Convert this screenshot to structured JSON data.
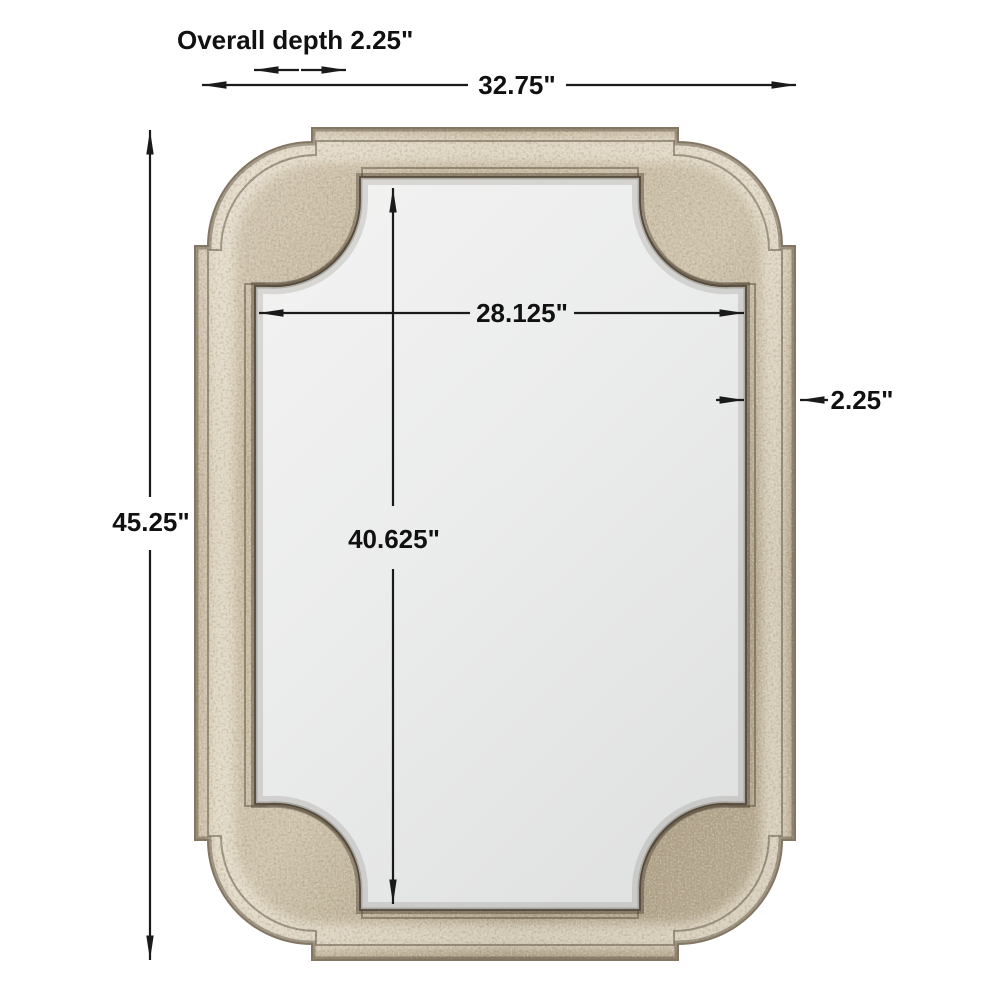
{
  "diagram": {
    "kind": "product-dimension-diagram",
    "subject": "antique silver framed wall mirror with scalloped stepped corners",
    "labels": {
      "overall_depth": "Overall depth 2.25\"",
      "overall_width": "32.75\"",
      "overall_height": "45.25\"",
      "mirror_width": "28.125\"",
      "mirror_height": "40.625\"",
      "frame_thickness": "2.25\""
    },
    "colors": {
      "background": "#ffffff",
      "dimension_line": "#1a1a1a",
      "frame_silver_light": "#dbd2bf",
      "frame_silver_mid": "#c0b299",
      "frame_silver_dark": "#8a7a63",
      "frame_patina_dark": "#4d3f2c",
      "frame_seam": "#55493a",
      "glass_light": "#f3f3f2",
      "glass_dark": "#e2e3e3"
    }
  }
}
